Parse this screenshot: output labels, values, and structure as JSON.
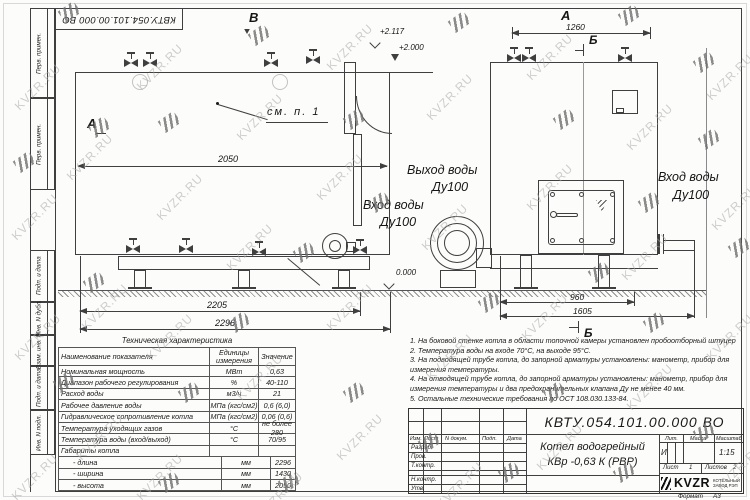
{
  "watermark": {
    "text": "KVZR.RU"
  },
  "frame": {
    "top_stamp": "КВТУ.054.101.00.000 ВО",
    "side_labels": [
      "Перв. примен.",
      "Перв. примен.",
      "Подп. и дата",
      "Инв. N дубл.",
      "Взам. инв. N",
      "Подп. и дата",
      "Инв. N подл."
    ]
  },
  "views": {
    "view_b_label": "В",
    "view_a_arrow_label": "А",
    "view_a_label": "А",
    "section_b_label": "Б",
    "see_note": "см. п. 1",
    "elev_2117": "+2.117",
    "elev_2000": "+2.000",
    "elev_000": "0.000",
    "dim_2050": "2050",
    "dim_2205": "2205",
    "dim_2296": "2296",
    "dim_1260": "1260",
    "dim_960": "960",
    "dim_1605": "1605",
    "outlet_label_1": "Выход воды",
    "outlet_label_2": "Ду100",
    "inlet_mid_label_1": "Вход воды",
    "inlet_mid_label_2": "Ду100",
    "inlet_right_label_1": "Вход воды",
    "inlet_right_label_2": "Ду100"
  },
  "spec_table": {
    "title": "Техническая характеристика",
    "headers": [
      "Наименование показателя",
      "Единицы измерения",
      "Значение"
    ],
    "rows": [
      {
        "name": "Номинальная мощность",
        "unit": "МВт",
        "value": "0,63"
      },
      {
        "name": "Диапазон рабочего регулирования",
        "unit": "%",
        "value": "40-110"
      },
      {
        "name": "Расход воды",
        "unit": "м3/ч",
        "value": "21"
      },
      {
        "name": "Рабочее давление воды",
        "unit": "МПа (кгс/см2)",
        "value": "0,6 (6,0)"
      },
      {
        "name": "Гидравлическое сопротивление котла",
        "unit": "МПа (кгс/см2)",
        "value": "0,06 (0,6)"
      },
      {
        "name": "Температура уходящих газов",
        "unit": "°С",
        "value": "не более 280"
      },
      {
        "name": "Температура воды (вход/выход)",
        "unit": "°С",
        "value": "70/95"
      },
      {
        "name": "Габариты котла",
        "unit": "",
        "value": ""
      },
      {
        "name": "- длина",
        "unit": "мм",
        "value": "2296"
      },
      {
        "name": "- ширина",
        "unit": "мм",
        "value": "1430"
      },
      {
        "name": "- высота",
        "unit": "мм",
        "value": "2050"
      }
    ]
  },
  "notes": [
    "1.  На боковой стенке котла в области топочной камеры установлен пробоотборный штуцер",
    "2.  Температура воды на входе 70°С, на выходе 95°С.",
    "3.  На подводящей трубе котла, до запорной арматуры установлены: манометр, прибор для измерения температуры.",
    "4.  На отводящей трубе котла, до запорной арматуры установлены: манометр, прибор для измерения температуры и два предохранительных клапана Ду не менее 40 мм.",
    "5.  Остальные технические требования по ОСТ 108.030.133-84."
  ],
  "stamp": {
    "doc_number": "КВТУ.054.101.00.000  ВО",
    "product_line1": "Котел водогрейный",
    "product_line2": "КВр -0,63  К  (РВР)",
    "cols": [
      "Изм.",
      "Лист",
      "N докум.",
      "Подп.",
      "Дата"
    ],
    "rows": [
      "Разраб.",
      "Пров.",
      "Т.контр.",
      "Н.контр.",
      "Утв."
    ],
    "lit_label": "Лит.",
    "lit_value": "И",
    "mass_label": "Масса",
    "scale_label": "Масштаб",
    "scale_value": "1:15",
    "sheet_label": "Лист",
    "sheet_value": "1",
    "sheets_label": "Листов",
    "sheets_value": "2",
    "logo_text": "KVZR",
    "logo_sub1": "КОТЕЛЬНЫЙ",
    "logo_sub2": "ЗАВОД РЭП",
    "format_label": "Формат",
    "format_value": "А3"
  }
}
